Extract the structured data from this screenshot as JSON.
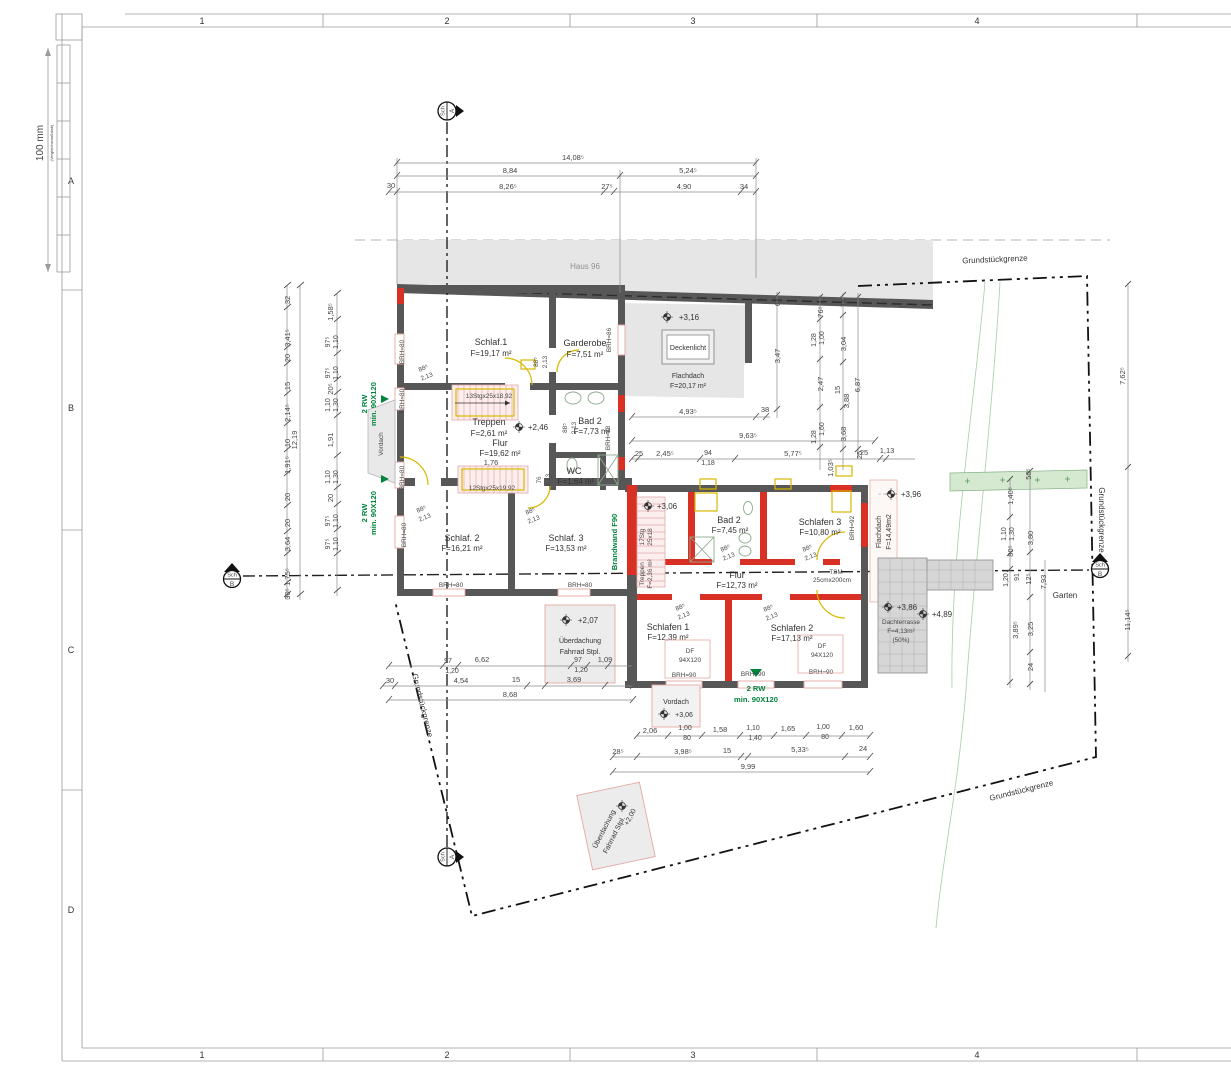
{
  "sheet": {
    "cols": [
      "1",
      "2",
      "3",
      "4"
    ],
    "rows": [
      "A",
      "B",
      "C",
      "D"
    ],
    "scale_label": "100 mm",
    "scale_sub": "(Vergleichsmaßstab)"
  },
  "site": {
    "neighbor": "Haus 96",
    "boundary": "Grundstückgrenze",
    "garten": "Garten",
    "sch": "Sch",
    "sec_a": "A",
    "sec_b": "B"
  },
  "rooms": {
    "schlaf1_name": "Schlaf.1",
    "schlaf1_area": "F=19,17 m²",
    "garderobe_name": "Garderobe",
    "garderobe_area": "F=7,51 m²",
    "treppen1_name": "Treppen",
    "treppen1_area": "F=2,61 m²",
    "flur1_name": "Flur",
    "flur1_area": "F=19,62 m²",
    "flur1_dim": "1,76",
    "bad2og_name": "Bad 2",
    "bad2og_area": "F=7,73 m²",
    "wc_name": "WC",
    "wc_area": "F=1,64 m²",
    "schlaf2_name": "Schlaf. 2",
    "schlaf2_area": "F=16,21 m²",
    "schlaf3_name": "Schlaf. 3",
    "schlaf3_area": "F=13,53 m²",
    "flachdach1_name": "Flachdach",
    "flachdach1_area": "F=20,17 m²",
    "deckenlicht": "Deckenlicht",
    "bad2dg_name": "Bad 2",
    "bad2dg_area": "F=7,45 m²",
    "schlafen3_name": "Schlafen 3",
    "schlafen3_area": "F=10,80 m²",
    "flur2_name": "Flur",
    "flur2_area": "F=12,73 m²",
    "schlafen1_name": "Schlafen 1",
    "schlafen1_area": "F=12,39 m²",
    "schlafen2_name": "Schlafen 2",
    "schlafen2_area": "F=17,13 m²",
    "treppen2_name": "Treppen",
    "treppen2_area": "F=2,36 m²",
    "flachdach2_name": "Flachdach",
    "flachdach2_area": "F=14,49m2",
    "dachterrasse_name": "Dachterrasse",
    "dachterrasse_area": "F=4,13m²",
    "dachterrasse_pct": "(50%)"
  },
  "levels": {
    "haus_roof": "+3,16",
    "og_stair": "+2,46",
    "dg_stair": "+3,06",
    "vordach": "+3,06",
    "carport1": "+2,07",
    "flachdach2": "+3,96",
    "terrasse": "+3,86",
    "terrasse2": "+4,89",
    "carport2": "+2,00"
  },
  "ann": {
    "rw_line1": "2 RW",
    "rw_line2": "min. 90X120",
    "brandwand": "Brandwand F90",
    "stair1": "13Stgx25x18,92",
    "stair2": "12Stgx25x19,92",
    "stair3a": "17Stg",
    "stair3b": "25x18",
    "vordach": "Vordach",
    "ueberdachung1": "Überdachung",
    "ueberdachung2": "Fahrrad Stpl.",
    "df": "DF",
    "df_size": "94X120",
    "tsm": "TSM",
    "tsm_size": "25cmx200cm"
  },
  "brh": {
    "b80": "BRH=80",
    "b86": "BRH=86",
    "b88": "BRH=88",
    "b90": "BRH=90",
    "b92": "BRH=92"
  },
  "door": {
    "w": "88⁵",
    "h": "2,13",
    "wc_w": "76"
  },
  "dims": {
    "top": [
      "14,08⁵",
      "8,84",
      "5,24⁵",
      "30",
      "8,26⁵",
      "27⁵",
      "4,90",
      "34"
    ],
    "left_total": "12,19",
    "la": [
      "32",
      "3,41⁵",
      "20",
      "15",
      "2,14⁵",
      "10",
      "1,91⁵",
      "20",
      "20",
      "3,64",
      "1,75⁵",
      "30⁵"
    ],
    "lb": [
      "1,58⁵",
      "97⁵",
      "1,10",
      "97⁵",
      "1,10",
      "20⁵",
      "1,10",
      "1,30",
      "1,91",
      "1,10",
      "1,30",
      "20",
      "97⁵",
      "1,10",
      "97⁵",
      "1,10"
    ],
    "mid": [
      "4,93⁵",
      "38",
      "9,63⁵",
      "25",
      "2,45⁵",
      "94",
      "1,18",
      "5,77⁵",
      "25",
      "1,13"
    ],
    "rv": [
      "67",
      "76⁵",
      "74",
      "1,00",
      "1,28",
      "3,04",
      "3,47",
      "2,47",
      "15",
      "6,87",
      "3,88",
      "1,60",
      "1,28",
      "3,68",
      "1,03⁵",
      "25"
    ],
    "rs": [
      "50⁵",
      "1,40⁵",
      "1,10",
      "1,30",
      "80⁵",
      "3,80",
      "91",
      "1,20",
      "12⁵",
      "7,93",
      "3,89⁵",
      "3,25",
      "24",
      "7,62⁵",
      "11,14⁵"
    ],
    "b1": [
      "2,06",
      "1,00",
      "80",
      "1,58",
      "1,10",
      "1,40",
      "1,65",
      "1,00",
      "80",
      "1,60"
    ],
    "b2": [
      "28⁵",
      "3,98⁵",
      "15",
      "5,33⁵",
      "24"
    ],
    "b3": "9,99",
    "bl": [
      "97",
      "1,20",
      "6,62",
      "97",
      "1,20",
      "1,09",
      "30",
      "4,54",
      "15",
      "3,69",
      "8,68"
    ]
  },
  "colors": {
    "wall": "#575757",
    "new_red": "#d93025",
    "yellow": "#d9b800",
    "green": "#00843d",
    "roof_gray": "#e3e3e3"
  }
}
